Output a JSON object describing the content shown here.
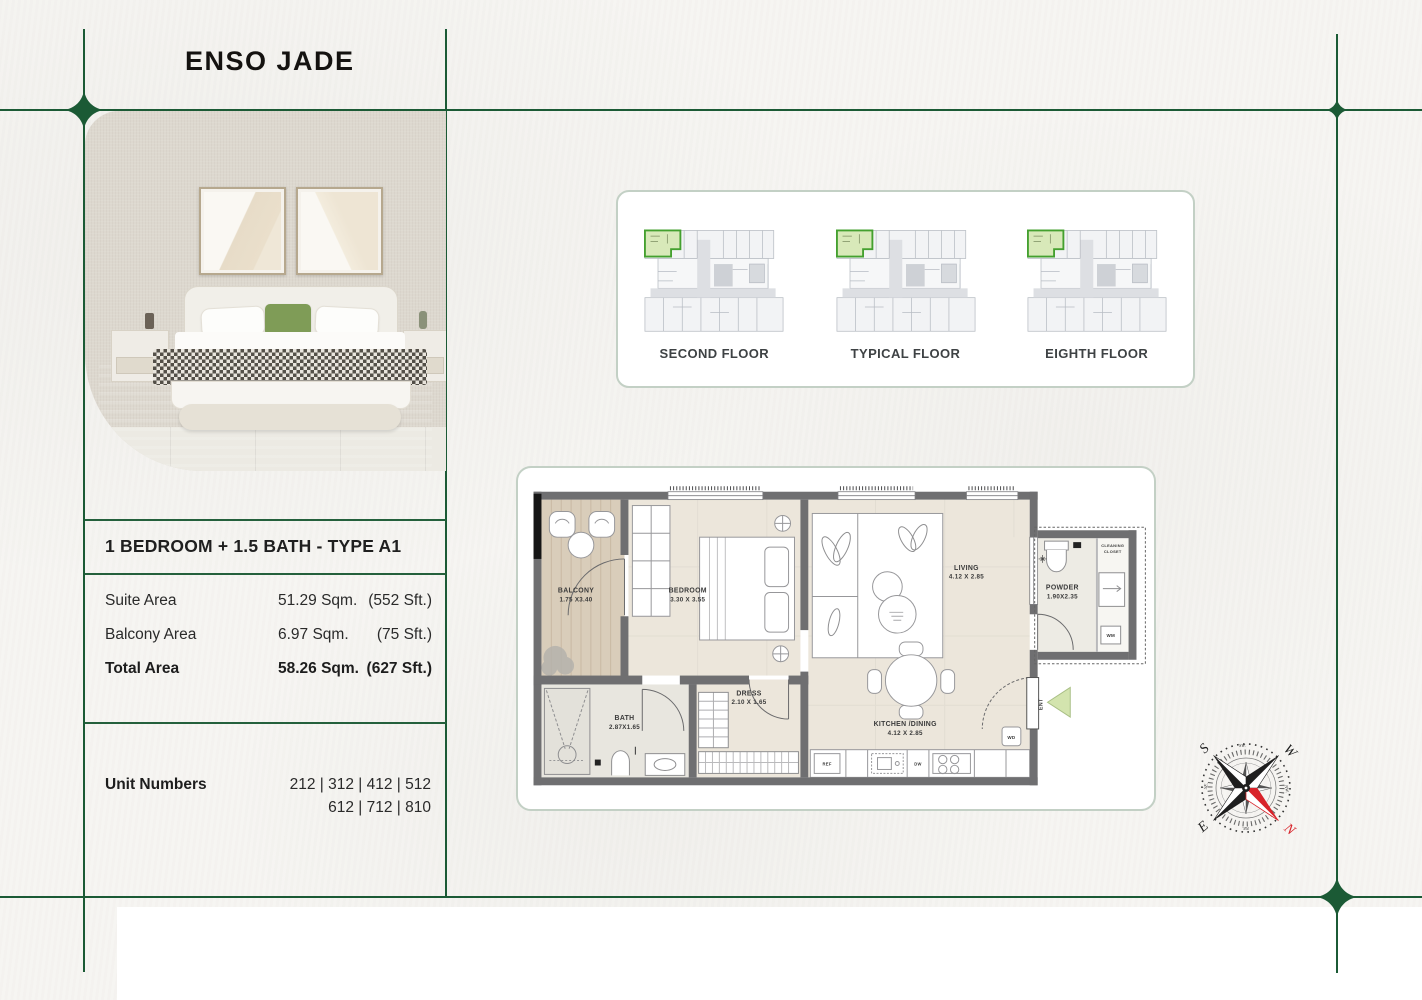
{
  "brand": {
    "logo_text": "ENSO JADE"
  },
  "left_panel": {
    "title": "1 BEDROOM + 1.5 BATH - TYPE A1",
    "areas": [
      {
        "label": "Suite Area",
        "sqm": "51.29 Sqm.",
        "sft": "(552 Sft.)"
      },
      {
        "label": "Balcony Area",
        "sqm": "6.97 Sqm.",
        "sft": "(75 Sft.)"
      },
      {
        "label": "Total Area",
        "sqm": "58.26 Sqm.",
        "sft": "(627 Sft.)"
      }
    ],
    "unit_numbers_label": "Unit Numbers",
    "unit_numbers_line1": "212 | 312 | 412 | 512",
    "unit_numbers_line2": "612 | 712 | 810"
  },
  "key_plans": {
    "floors": [
      {
        "label": "SECOND FLOOR"
      },
      {
        "label": "TYPICAL FLOOR"
      },
      {
        "label": "EIGHTH FLOOR"
      }
    ]
  },
  "floor_plan": {
    "rooms": {
      "balcony": {
        "name": "BALCONY",
        "dims": "1.75 X3.40"
      },
      "bedroom": {
        "name": "BEDROOM",
        "dims": "3.30 X 3.55"
      },
      "living": {
        "name": "LIVING",
        "dims": "4.12 X 2.85"
      },
      "powder": {
        "name": "POWDER",
        "dims": "1.90X2.35"
      },
      "dress": {
        "name": "DRESS",
        "dims": "2.10 X 1.65"
      },
      "bath": {
        "name": "BATH",
        "dims": "2.87X1.65"
      },
      "kitchen": {
        "name": "KITCHEN /DINING",
        "dims": "4.12 X 2.85"
      }
    },
    "tags": {
      "cleaning_line1": "CLEANING",
      "cleaning_line2": "CLOSET",
      "entry": "ENT",
      "washer_dryer": "WD",
      "washing_machine": "WM",
      "fridge": "REF",
      "dishwasher": "DW"
    }
  },
  "compass": {
    "north": "N",
    "south": "S",
    "east": "E",
    "west": "W",
    "southwest": "SW.",
    "northwest": "NW.",
    "northeast": "NE.",
    "southeast": "SE.",
    "north_color": "#d8232a"
  },
  "theme": {
    "line_green": "#1b5a35",
    "highlight_green": "#3f9a2e",
    "paper": "#f6f5f2"
  }
}
